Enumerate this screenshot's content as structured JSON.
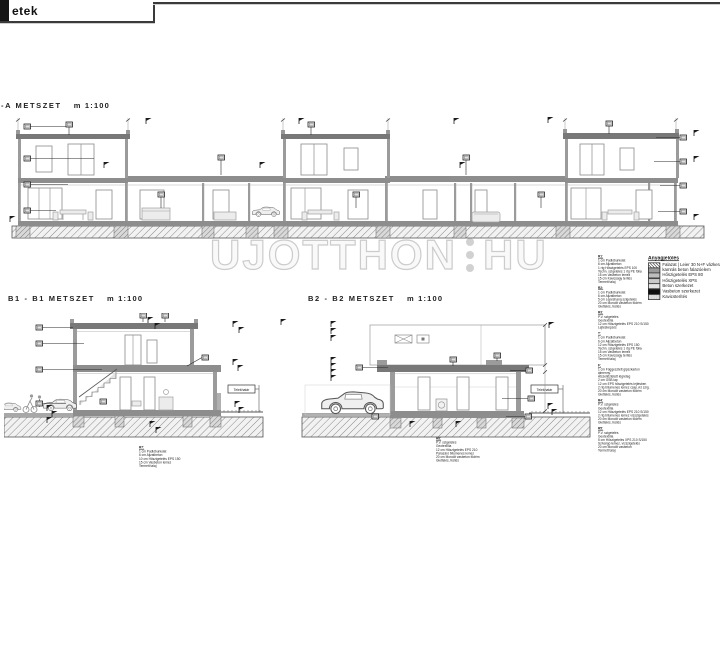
{
  "header": {
    "tab_label": "etek"
  },
  "watermark": {
    "left": "UJOTTHON",
    "right": "HU"
  },
  "sections": {
    "aa": {
      "title": "-A METSZET",
      "scale": "m 1:100"
    },
    "b1": {
      "title": "B1 - B1 METSZET",
      "scale": "m 1:100"
    },
    "b2": {
      "title": "B2 - B2 METSZET",
      "scale": "m 1:100"
    }
  },
  "labels": {
    "property_line": "Telekhatár"
  },
  "colors": {
    "line": "#2e2e2e",
    "wall": "#9b9b9b",
    "slab": "#8d8d8d",
    "ground_hatch": "#8a8a8a"
  },
  "legend": {
    "title": "Anyagjelölés",
    "items": [
      {
        "swatch": "hatch",
        "label": "Falazat | Leier 30 N+F vázkerámia"
      },
      {
        "swatch": "g1",
        "label": "kamrás beton falazóelem"
      },
      {
        "swatch": "g2",
        "label": "Hőszigetelés EPS 80"
      },
      {
        "swatch": "g3",
        "label": "Hőszigetelés XPS"
      },
      {
        "swatch": "pale",
        "label": "Beton szerkezet"
      },
      {
        "swatch": "black",
        "label": "Vasbeton szerkezet"
      },
      {
        "swatch": "speckle",
        "label": "Kavicsterítés"
      }
    ]
  },
  "notes_right": {
    "groups": [
      {
        "heading": "R1:",
        "lines": [
          "1 cm Padlóburkolat",
          "6 cm Aljzatbeton",
          "1 rtg Hőszigetelés EPS 100",
          "Techn. szigetelés 1 rtg PE fólia",
          "15 cm Vasbeton lemez",
          "15 cm Kavicságy terítés",
          "Termett talaj"
        ]
      },
      {
        "heading": "R2:",
        "lines": [
          "1 cm Padlóburkolat",
          "6 cm Aljzatbeton",
          "5 cm Lépéshang szigetelés",
          "20 cm Monolit vasbeton födém",
          "Glettelés, festés"
        ]
      },
      {
        "heading": "R3:",
        "lines": [
          "P.V. szigetelés",
          "Geotextília",
          "12 cm Hőszigetelés EPS 210 S/150",
          "Lejtésképzés"
        ]
      },
      {
        "heading": "T:",
        "lines": [
          "1 cm Padlóburkolat",
          "6 cm Aljzatbeton",
          "12 cm Hőszigetelés EPS 150",
          "Techn. szigetelés 1 rtg PE fólia",
          "15 cm Vasbeton lemez",
          "15 cm Kavicságy terítés",
          "Termett talaj"
        ]
      },
      {
        "heading": "F:",
        "lines": [
          "1 cm Függesztett gipszkarton álmenny.",
          "Átszellőztetett légréteg",
          "2 cm OSB lap",
          "12 cm EPS hőszigetelés lejtésben",
          "2 rtg bitumenes lemez csap.víz szig.",
          "20 cm Monolit vasbeton födém",
          "Glettelés, festés"
        ]
      },
      {
        "heading": "R4:",
        "lines": [
          "P.V. szigetelés",
          "Geotextília",
          "12 cm Hőszigetelés EPS 210 S/150",
          "2 rtg bitumenes lemez vízszigetelés",
          "20 cm Monolit vasbeton födém",
          "Glettelés, festés"
        ]
      },
      {
        "heading": "R5:",
        "lines": [
          "P.V. szigetelés",
          "Geotextília",
          "5 cm Hőszigetelés XPS 210 S/150",
          "Szivárgó lemez, vízszigetelés",
          "20 cm Monolit vasbeton",
          "Termett talaj"
        ]
      }
    ]
  },
  "notes_b1": {
    "lines": [
      "R7:",
      "1 cm Padlóburkolat",
      "6 cm Aljzatbeton",
      "10 cm Hőszigetelés EPS 150",
      "15 cm Vasbeton lemez",
      "Termett talaj"
    ]
  },
  "notes_b2": {
    "lines": [
      "R8:",
      "P.V. szigetelés",
      "Geotextília",
      "12 cm Hőszigetelés EPS 210",
      "Párazáró bitumenes lemez",
      "20 cm Monolit vasbeton födém",
      "Glettelés, festés"
    ]
  }
}
